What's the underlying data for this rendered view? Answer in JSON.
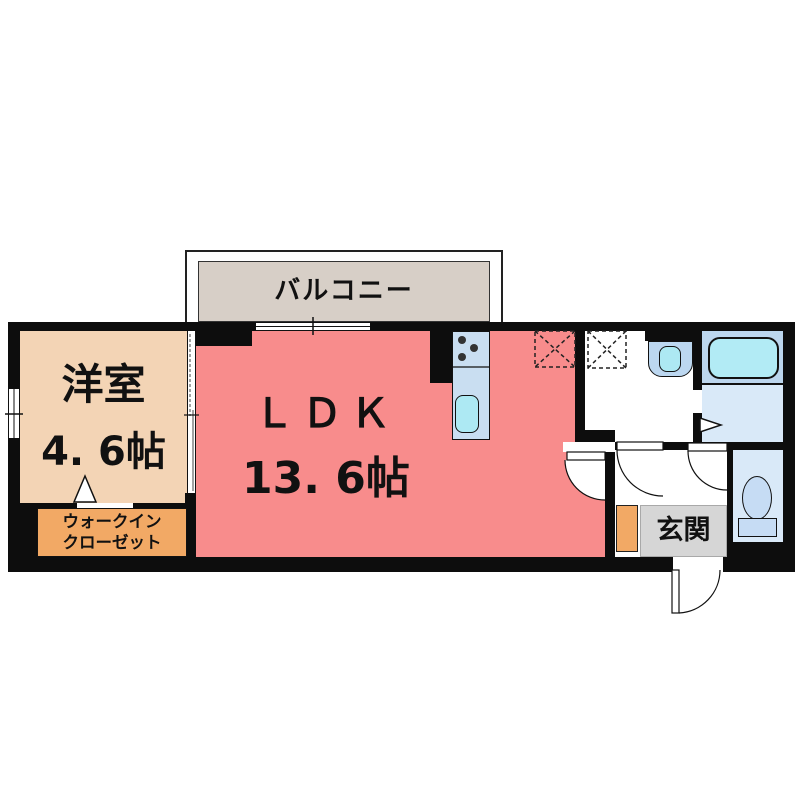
{
  "floorplan": {
    "title": "apartment-floorplan",
    "balcony": {
      "label": "バルコニー"
    },
    "western_room": {
      "label": "洋室",
      "size": "4. 6帖"
    },
    "ldk": {
      "label": "ＬＤＫ",
      "size": "13. 6帖"
    },
    "walk_in_closet": {
      "label_line1": "ウォークイン",
      "label_line2": "クローゼット"
    },
    "entrance": {
      "label": "玄関"
    },
    "fixtures": {
      "kitchen": "kitchen-counter-sink-and-burners-icon",
      "refrigerator_space": "dashed-x-box-icon",
      "washer_space": "dashed-x-box-icon",
      "washbasin": "washbasin-icon",
      "bathtub": "bathtub-icon",
      "toilet": "toilet-icon",
      "doors": "swing-door-arc-icon",
      "windows": "sliding-window-icon",
      "shoe_cabinet": "shoe-cabinet-block"
    },
    "colors": {
      "wall": "#0d0d0d",
      "ldk": "#f88c8c",
      "western_room": "#f3d4b5",
      "closet": "#f2a965",
      "balcony": "#d7cfc7",
      "genkan": "#d6d6d6",
      "water_area_mid": "#bcd6ee",
      "water_area_light": "#d9e9f8",
      "counter": "#c9def1",
      "sink_cyan": "#ade9f3",
      "fixture_blue": "#c6dcf4"
    }
  }
}
